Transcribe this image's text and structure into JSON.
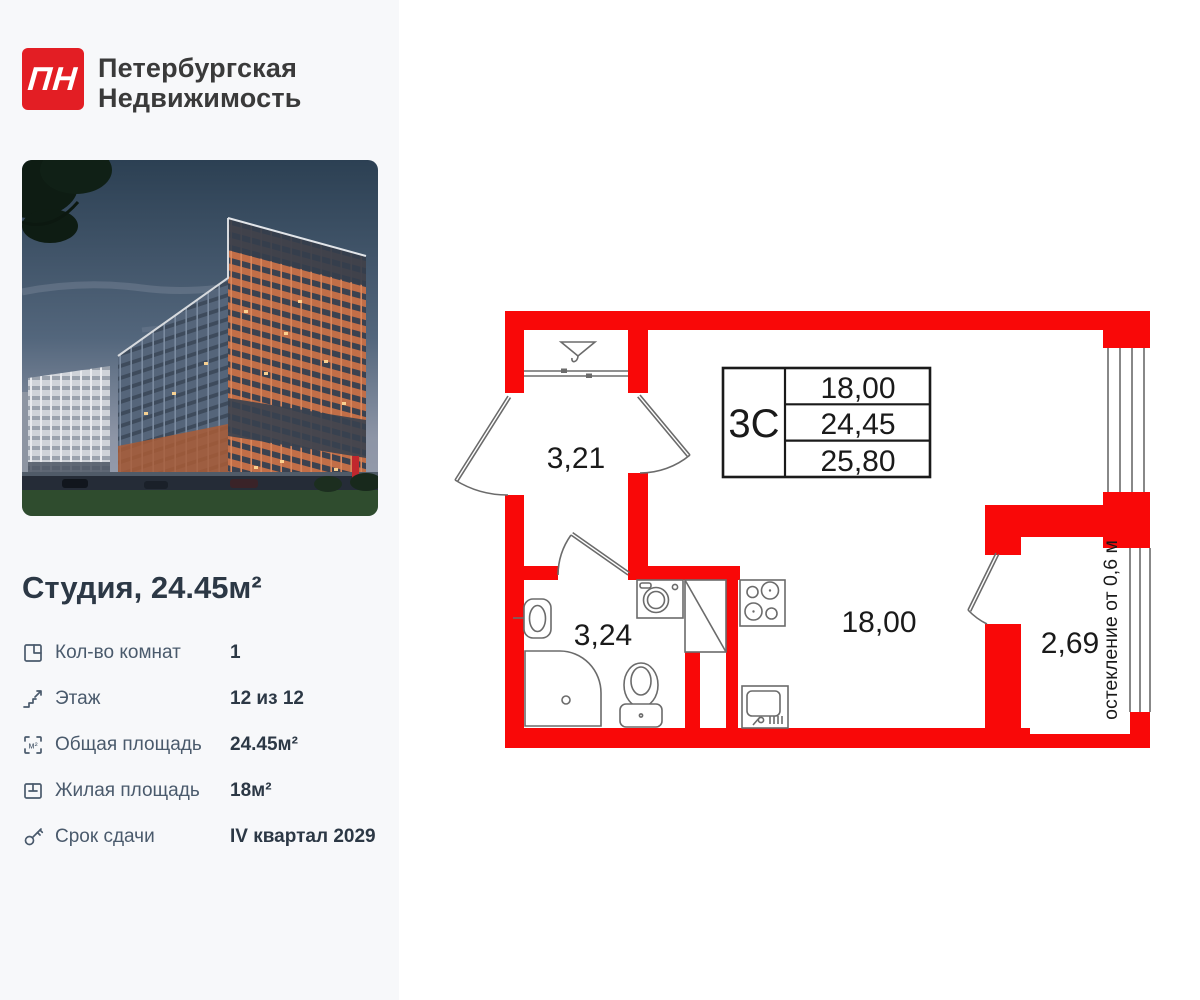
{
  "brand": {
    "logo_text": "ПН",
    "name_line1": "Петербургская",
    "name_line2": "Недвижимость"
  },
  "listing": {
    "title": "Студия, 24.45м²"
  },
  "details": {
    "area_icon_label": "м²",
    "rows": [
      {
        "label": "Кол-во комнат",
        "value": "1"
      },
      {
        "label": "Этаж",
        "value": "12 из 12"
      },
      {
        "label": "Общая площадь",
        "value": "24.45м²"
      },
      {
        "label": "Жилая площадь",
        "value": "18м²"
      },
      {
        "label": "Срок сдачи",
        "value": "IV квартал 2029"
      }
    ]
  },
  "floorplan": {
    "unit_code": "3С",
    "spec_rows": [
      "18,00",
      "24,45",
      "25,80"
    ],
    "rooms": {
      "hallway": "3,21",
      "bathroom": "3,24",
      "living": "18,00",
      "balcony": "2,69"
    },
    "glazing_note": "остекление от 0,6 м",
    "colors": {
      "wall_red": "#f90808",
      "outline_gray": "#6b6b6b",
      "logo_red": "#e31e24"
    }
  }
}
